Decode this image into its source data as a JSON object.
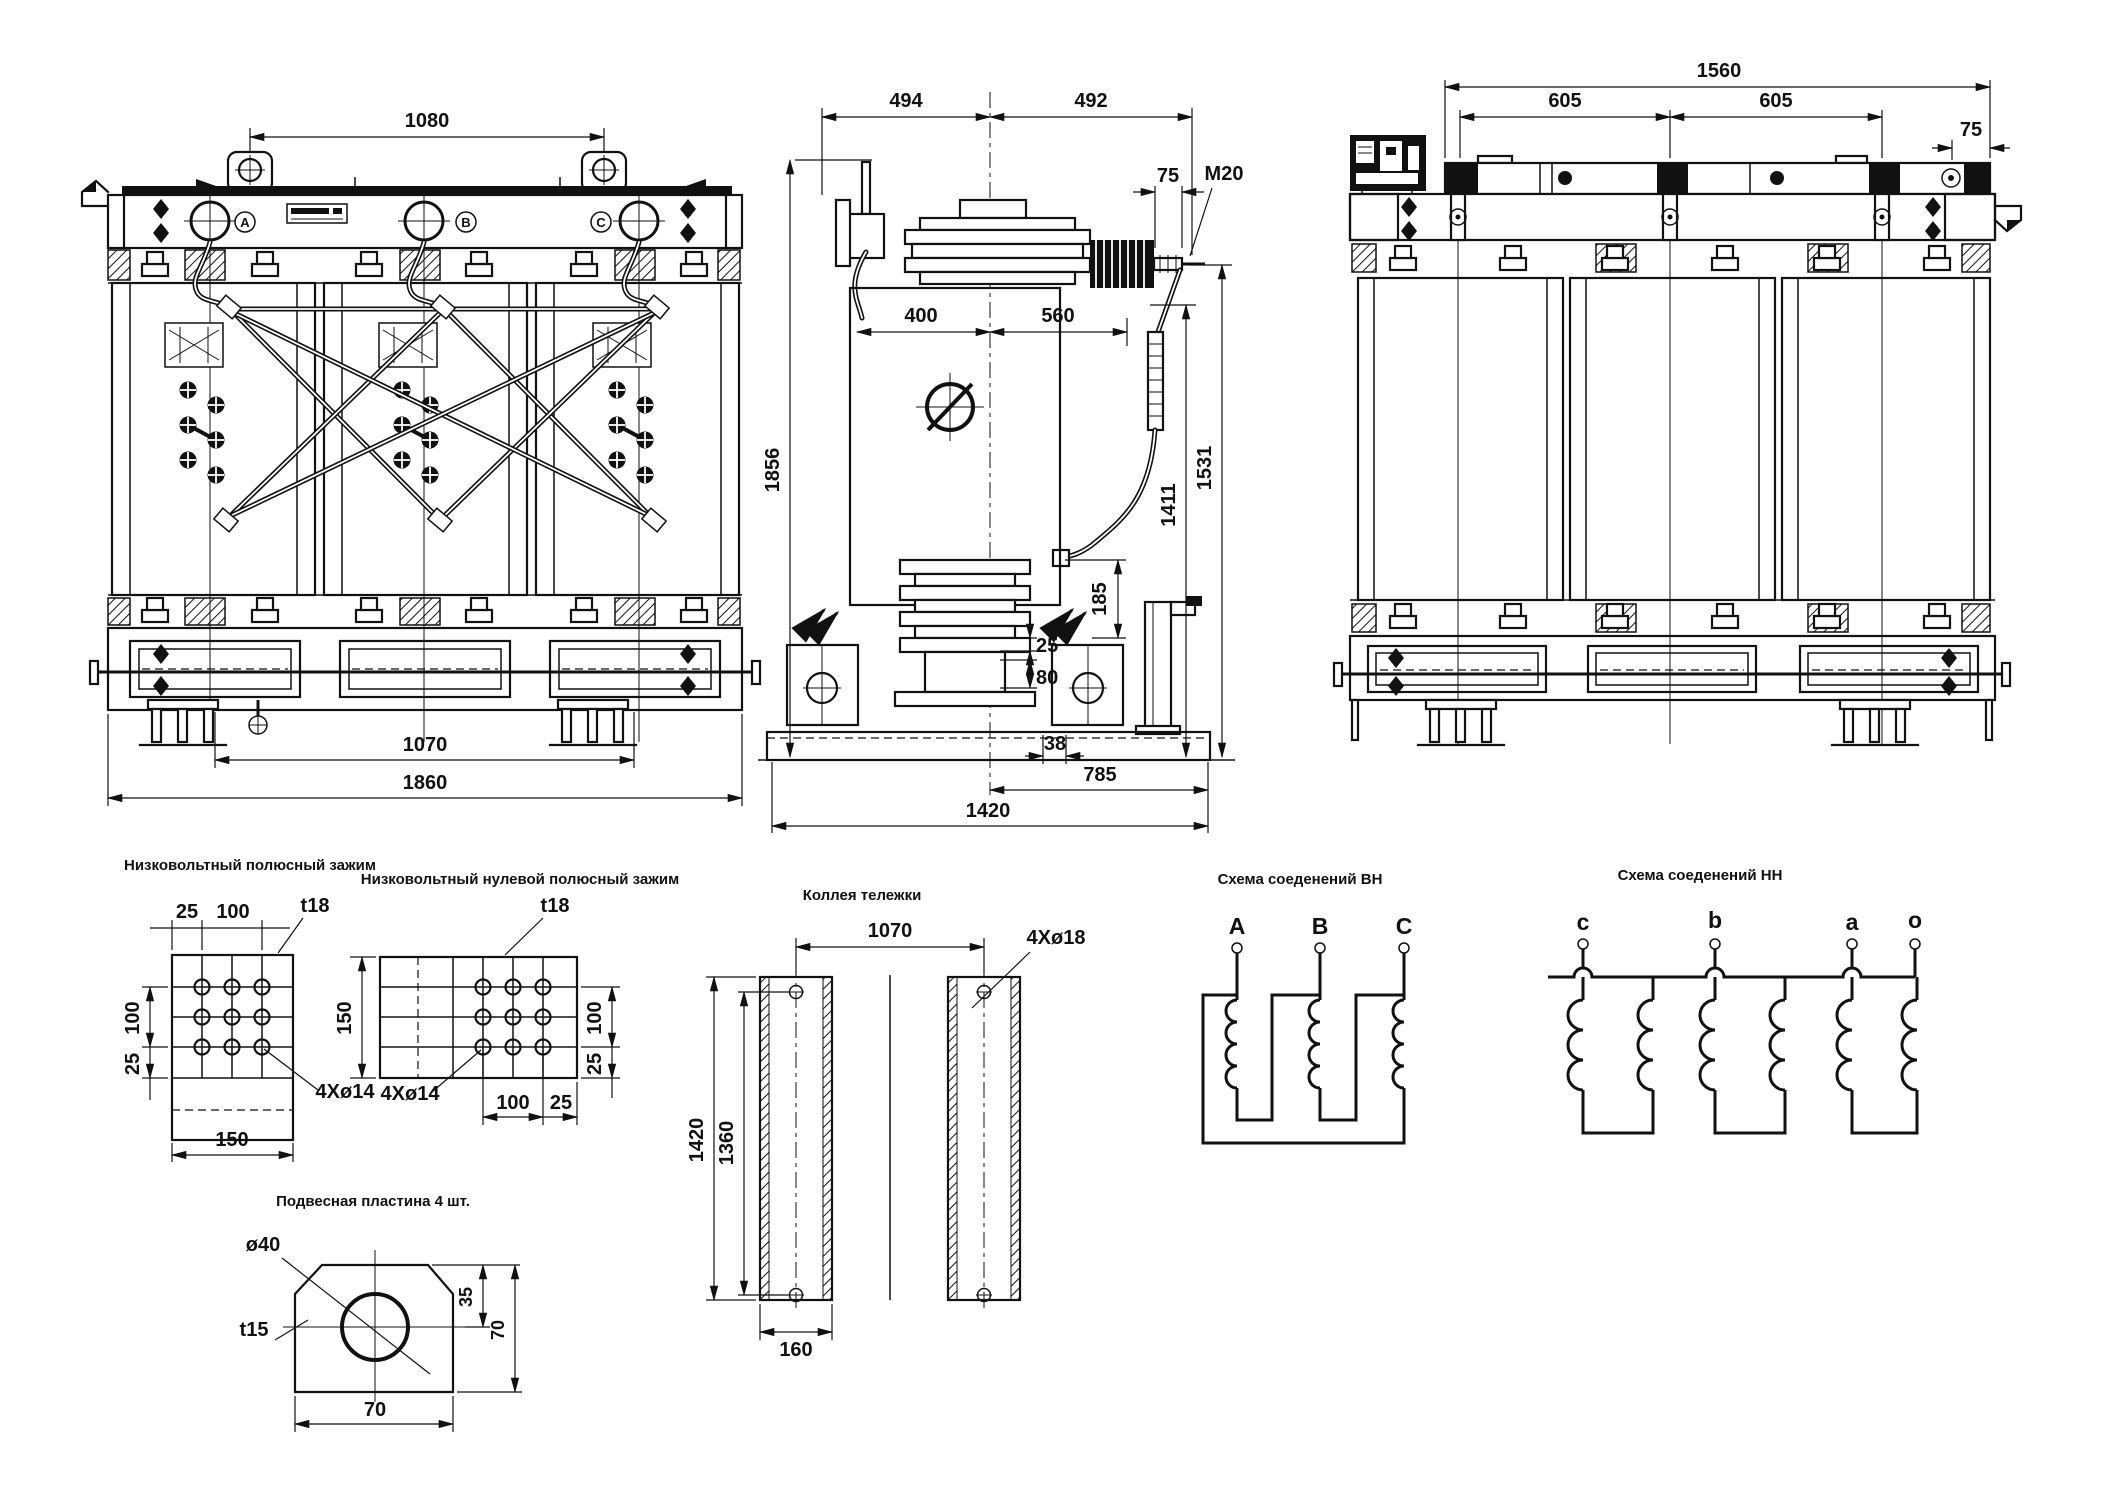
{
  "front_view": {
    "phases": [
      "A",
      "B",
      "C"
    ],
    "dims": {
      "lug_spacing": "1080",
      "wheel_span": "1070",
      "overall_width": "1860"
    }
  },
  "side_view": {
    "dims": {
      "left_half": "494",
      "right_half": "492",
      "stud": "75",
      "thread": "M20",
      "tank_left": "400",
      "tank_right": "560",
      "overall_height": "1856",
      "terminal_height": "1411",
      "stud_height": "1531",
      "bracket": "185",
      "gap": "25",
      "pad": "80",
      "plate": "38",
      "half_base": "785",
      "base_length": "1420"
    }
  },
  "rear_view": {
    "dims": {
      "overall_width": "1560",
      "pitch_left": "605",
      "pitch_right": "605",
      "end_offset": "75"
    }
  },
  "details": {
    "lv_clamp": {
      "title": "Низковольтный полюсный зажим",
      "dims": {
        "edge_h": "25",
        "pitch_h": "100",
        "thickness": "t18",
        "pitch_v": "100",
        "edge_v": "25",
        "holes": "4Xø14",
        "width": "150"
      }
    },
    "lv_neutral_clamp": {
      "title": "Низковольтный нулевой полюсный зажим",
      "dims": {
        "thickness": "t18",
        "height": "150",
        "pitch_v": "100",
        "edge_v": "25",
        "pitch_h": "100",
        "edge_h": "25",
        "holes": "4Xø14"
      }
    },
    "trolley": {
      "title": "Коллея тележки",
      "dims": {
        "gauge": "1070",
        "holes": "4Xø18",
        "length": "1420",
        "hole_span": "1360",
        "rail_width": "160"
      }
    },
    "hv_schema": {
      "title": "Схема соеденений ВН",
      "terminals": [
        "A",
        "B",
        "C"
      ]
    },
    "lv_schema": {
      "title": "Схема соеденений НН",
      "terminals": [
        "c",
        "b",
        "a",
        "o"
      ]
    },
    "plate": {
      "title": "Подвесная пластина 4 шт.",
      "dims": {
        "hole": "ø40",
        "thickness": "t15",
        "half_height": "35",
        "height": "70",
        "width": "70"
      }
    }
  }
}
